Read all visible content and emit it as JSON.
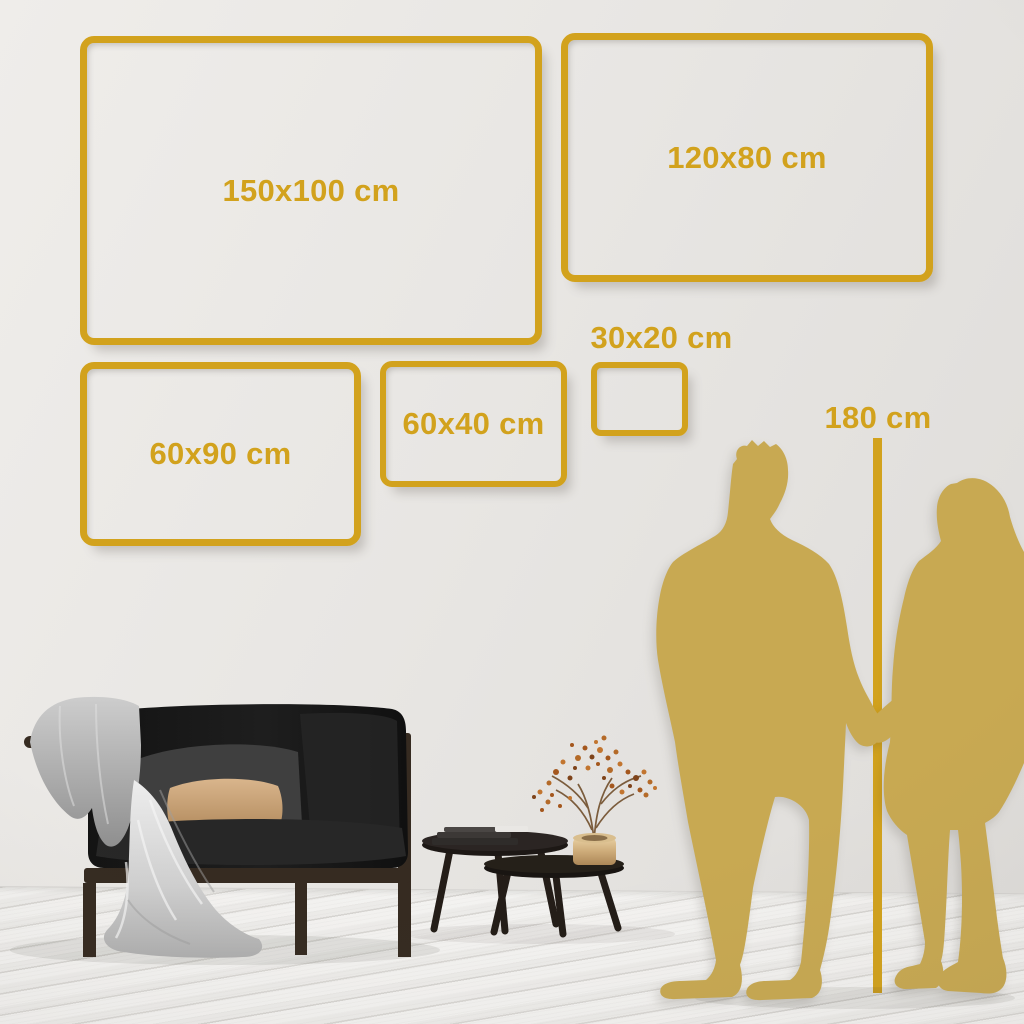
{
  "size_guide": {
    "unit": "cm",
    "frames": [
      {
        "id": "150x100",
        "label": "150x100 cm"
      },
      {
        "id": "120x80",
        "label": "120x80 cm"
      },
      {
        "id": "60x90",
        "label": "60x90 cm"
      },
      {
        "id": "60x40",
        "label": "60x40 cm"
      },
      {
        "id": "30x20",
        "label": "30x20 cm"
      }
    ],
    "height_reference": {
      "label": "180 cm"
    }
  },
  "scene": {
    "elements": [
      "dark-sofa",
      "throw-blanket",
      "gray-cushion",
      "tan-pillow",
      "nesting-coffee-tables",
      "books-stack",
      "brass-vase",
      "dried-branch",
      "man-silhouette",
      "woman-silhouette",
      "wood-plank-floor",
      "gray-wall"
    ]
  },
  "colors": {
    "accent_gold": "#D2A21D",
    "silhouette_gold": "#C8A952",
    "wall": "#E8E6E3",
    "floor": "#F3F2F0",
    "sofa_dark": "#1C1C1C",
    "wood_frame": "#362B21",
    "blanket_gray": "#C4C4C4",
    "cushion_gray": "#3F3F3F",
    "pillow_tan": "#C9A26E",
    "table_top": "#2B2523",
    "vase_brass": "#CDAB79",
    "berry_1": "#A4571D",
    "berry_2": "#C2752F",
    "berry_3": "#7E431A",
    "berry_4": "#B46A28"
  }
}
